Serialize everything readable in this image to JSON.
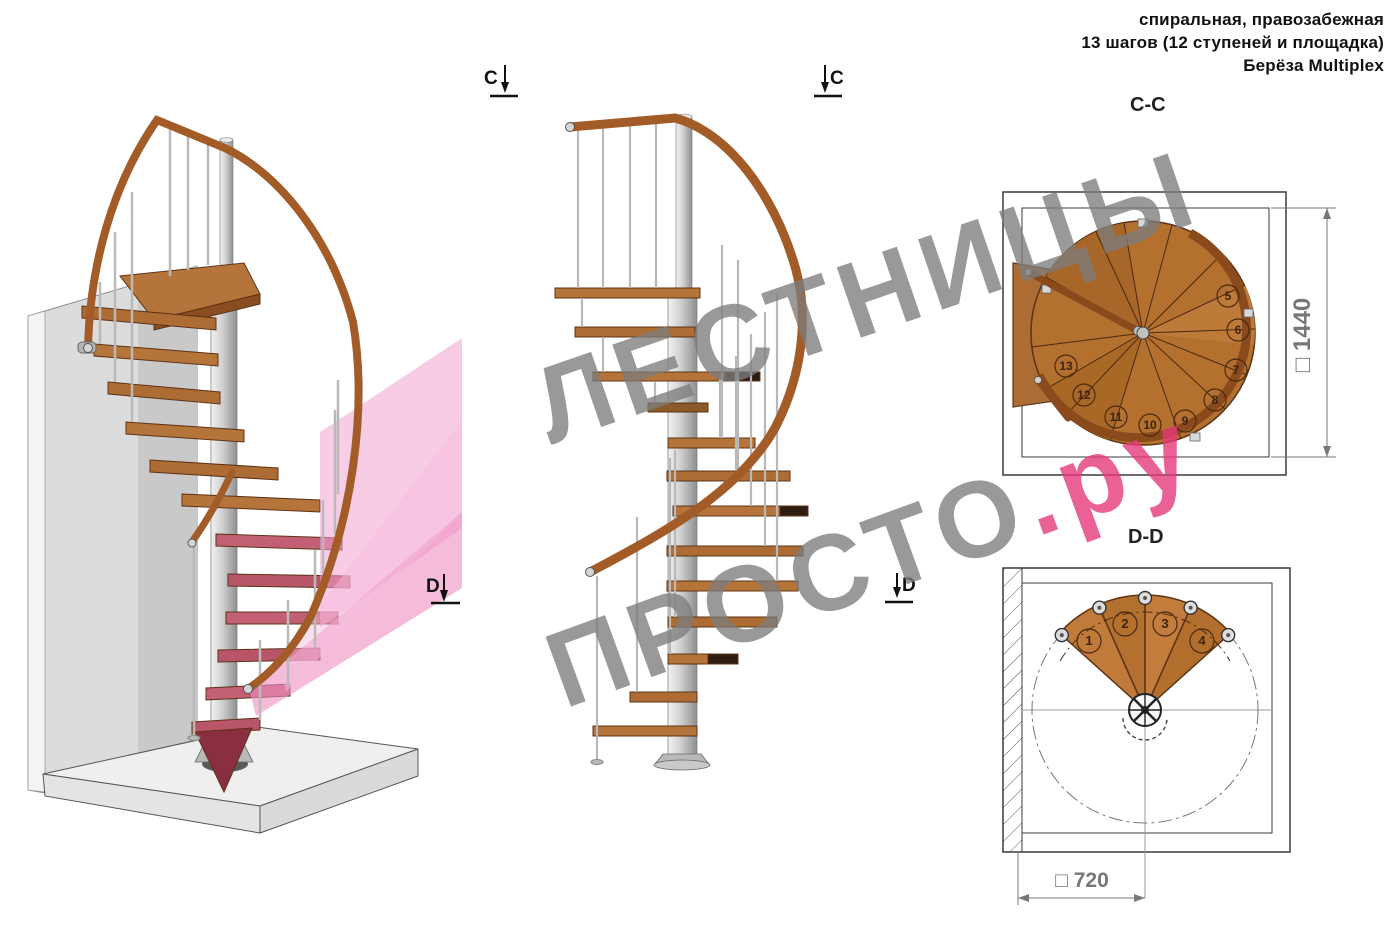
{
  "header": {
    "lines": [
      "спиральная, правозабежная",
      "13 шагов (12 ступеней и площадка)",
      "Берёза Multiplex"
    ]
  },
  "section_markers": {
    "c": "C",
    "d": "D"
  },
  "plans": {
    "cc": {
      "title": "C-C",
      "dim_label": "□ 1440",
      "steps": [
        "5",
        "6",
        "7",
        "8",
        "9",
        "10",
        "11",
        "12",
        "13"
      ]
    },
    "dd": {
      "title": "D-D",
      "dim_label": "□ 720",
      "steps": [
        "1",
        "2",
        "3",
        "4"
      ]
    }
  },
  "watermark": {
    "line1": "ЛЕСТНИЦЫ",
    "line2_main": "ПРОСТО",
    "line2_accent": ".ру"
  },
  "colors": {
    "wood": "#b5722f",
    "wood_dark": "#5c3317",
    "handrail": "#a35c28",
    "metal": "#c9c9c9",
    "wall": "#dcdcdc",
    "floor": "#efefef",
    "section_plane_pink": "#f2a3cf",
    "highlighted_steps_pink": "#c35f74",
    "watermark_gray": "#7d7d7d",
    "watermark_pink": "#e5397a",
    "drawing_line": "#3a3a3a",
    "dim_text": "#8a8a8a"
  }
}
